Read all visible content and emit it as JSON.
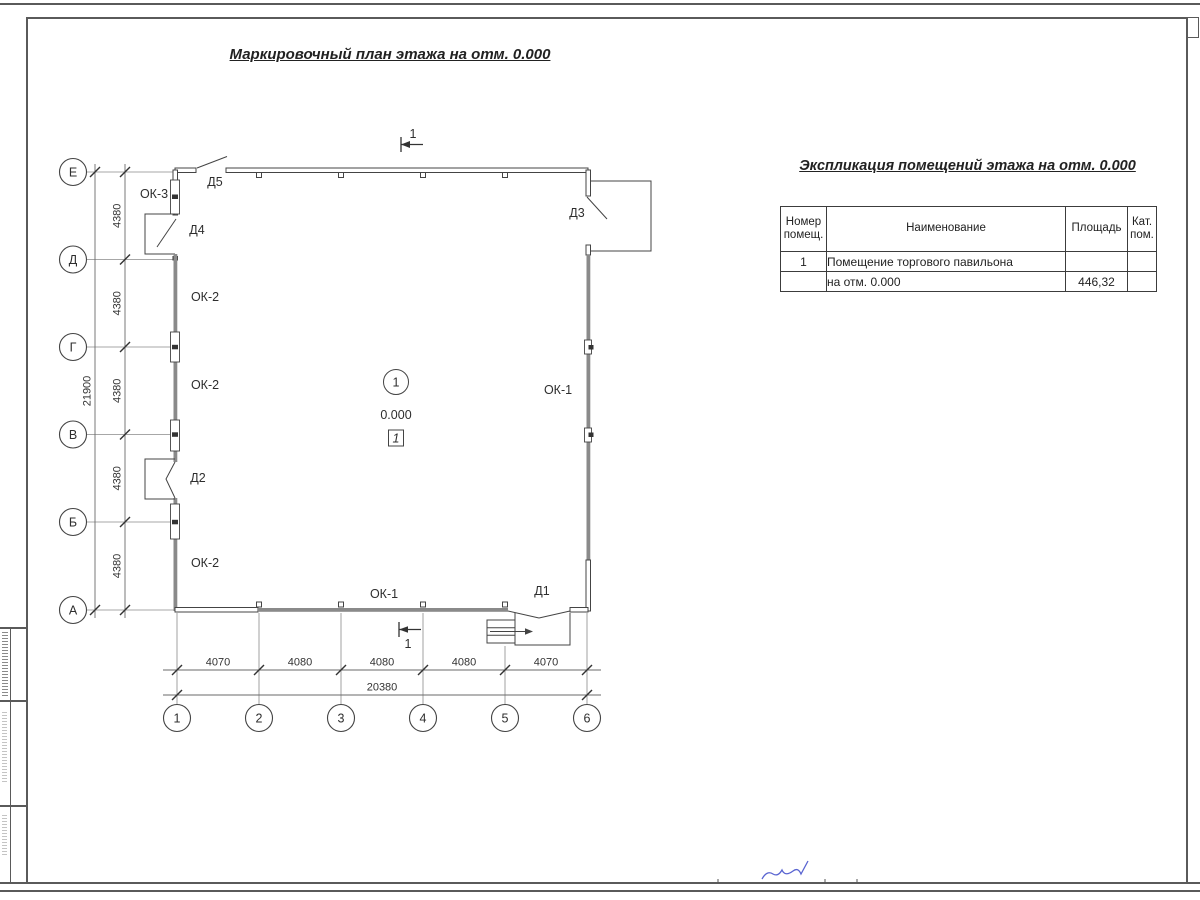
{
  "page": {
    "title": "Маркировочный план этажа на отм. 0.000"
  },
  "axes": {
    "rows": [
      "Е",
      "Д",
      "Г",
      "В",
      "Б",
      "А"
    ],
    "row_dims": [
      "4380",
      "4380",
      "4380",
      "4380",
      "4380"
    ],
    "row_total": "21900",
    "cols": [
      "1",
      "2",
      "3",
      "4",
      "5",
      "6"
    ],
    "col_dims": [
      "4070",
      "4080",
      "4080",
      "4080",
      "4070"
    ],
    "col_total": "20380"
  },
  "plan": {
    "section_mark": "1",
    "room": {
      "number": "1",
      "elevation": "0.000",
      "tag": "1"
    },
    "labels": {
      "ok3": "ОК-3",
      "d5": "Д5",
      "d4": "Д4",
      "d3": "Д3",
      "d2": "Д2",
      "d1": "Д1",
      "ok2_top": "ОК-2",
      "ok2_mid": "ОК-2",
      "ok2_bottom": "ОК-2",
      "ok1_right": "ОК-1",
      "ok1_bottom": "ОК-1"
    }
  },
  "table": {
    "title": "Экспликация помещений этажа на отм. 0.000",
    "headers": [
      "Номер помещ.",
      "Наименование",
      "Площадь",
      "Кат. пом."
    ],
    "rows": [
      [
        "1",
        "Помещение торгового павильона",
        "",
        ""
      ],
      [
        "",
        "на отм. 0.000",
        "446,32",
        ""
      ]
    ]
  },
  "colors": {
    "line": "#444444",
    "wall_fill": "#8a8a8a",
    "signature_blue": "#3c49c9"
  }
}
